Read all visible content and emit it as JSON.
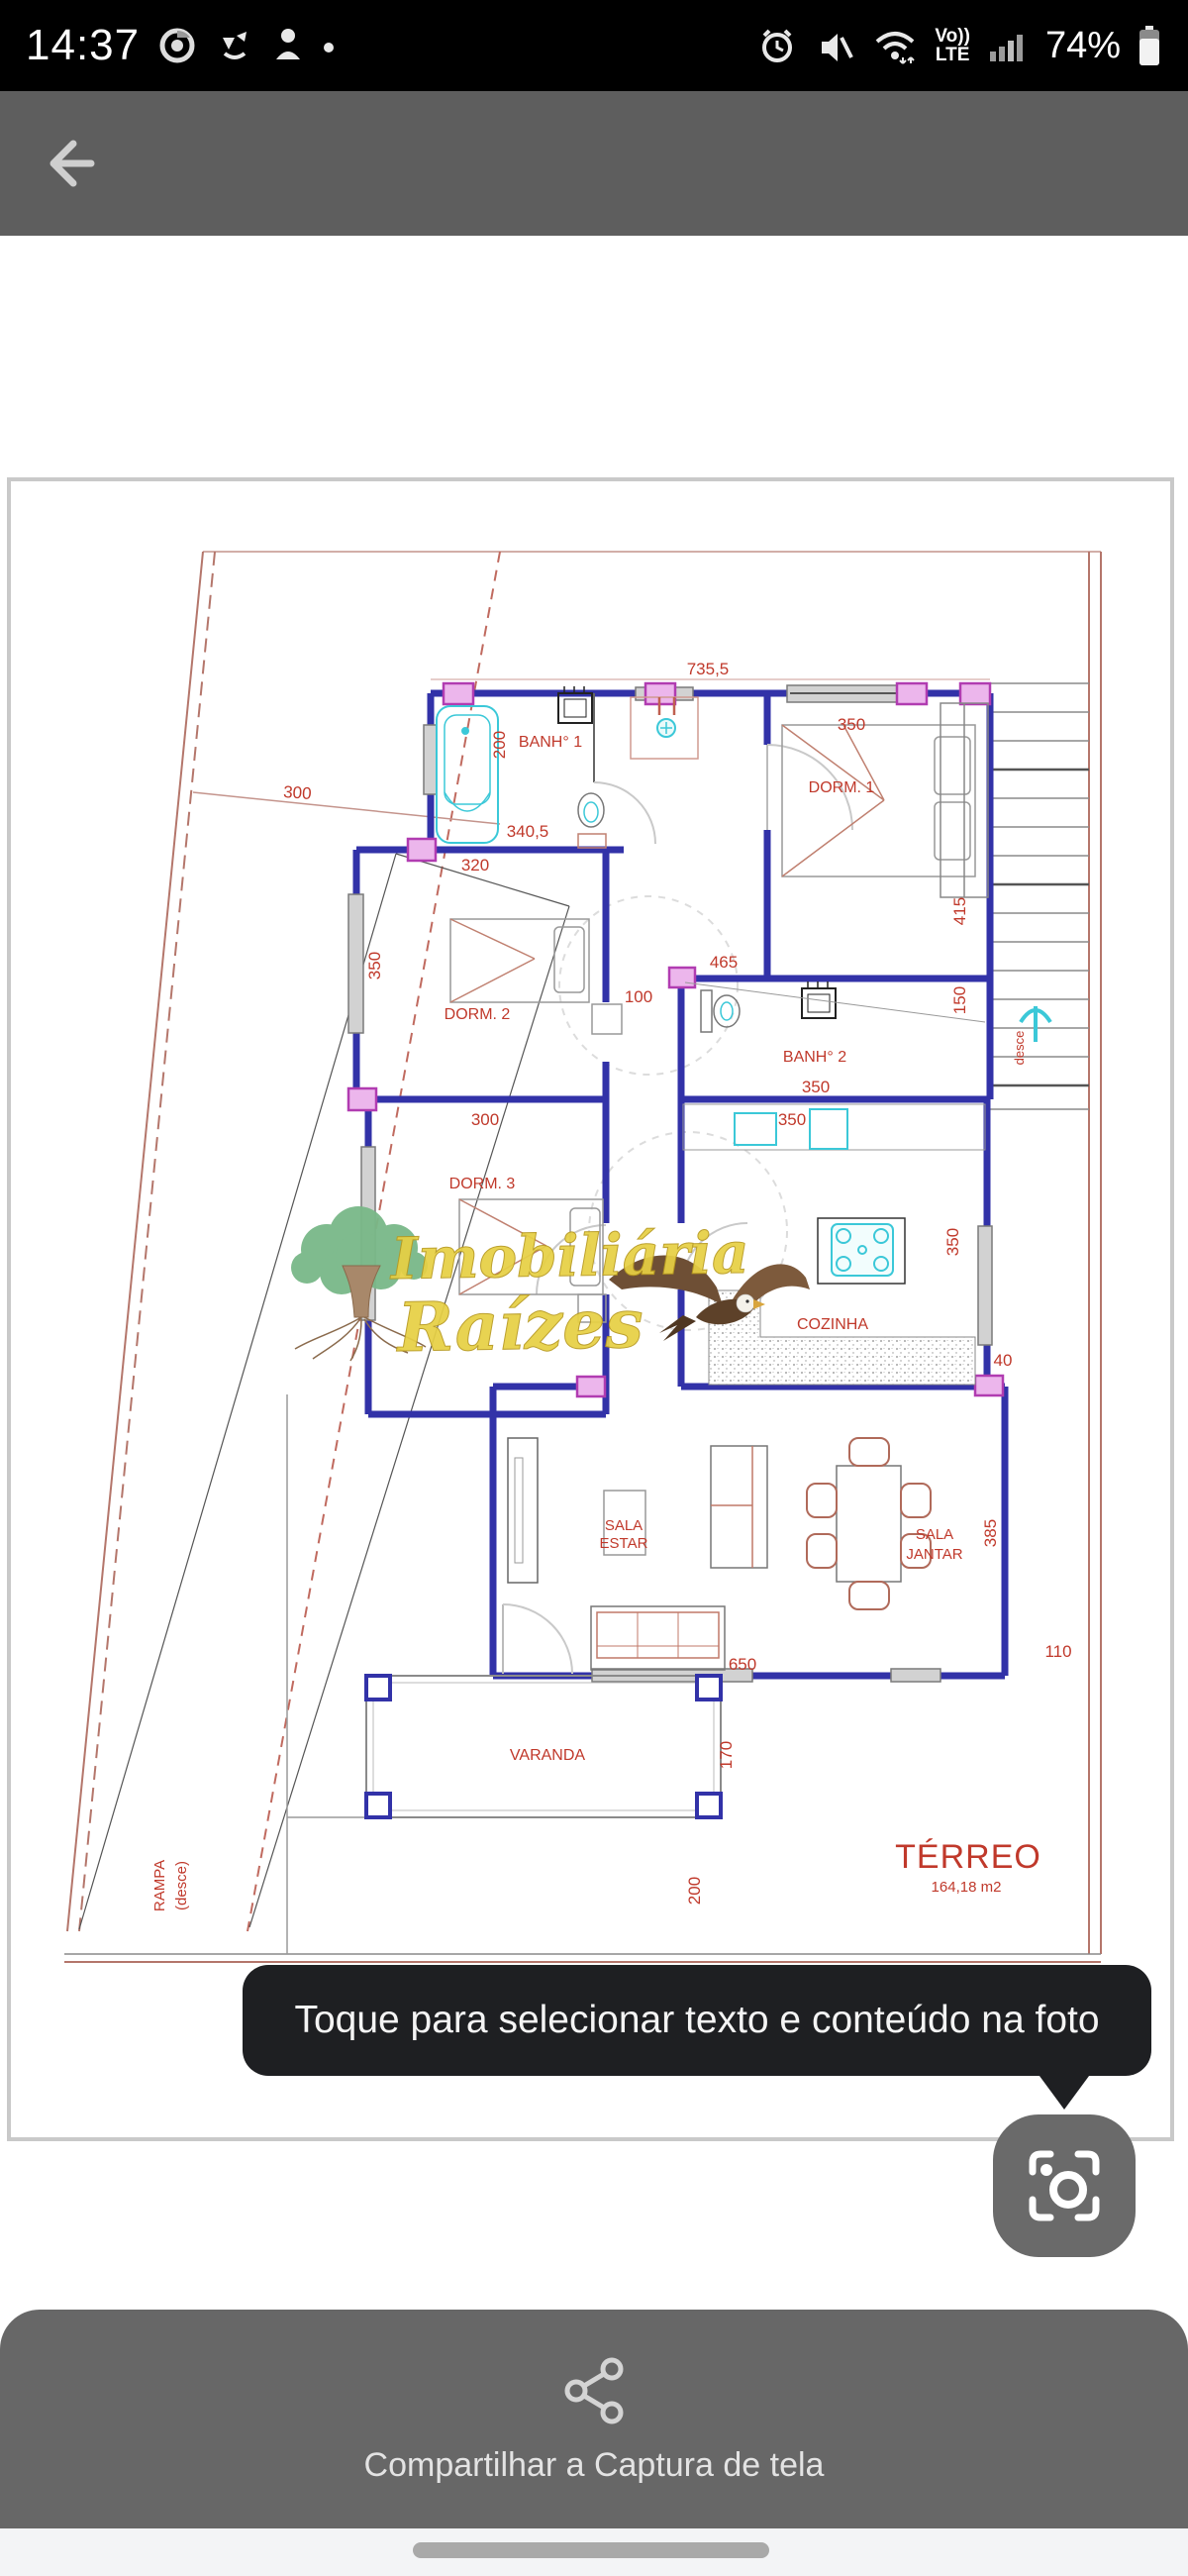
{
  "status_bar": {
    "time": "14:37",
    "battery": "74%",
    "volte_top": "Vo))",
    "volte_bottom": "LTE"
  },
  "tooltip": {
    "text": "Toque para selecionar texto e conteúdo na foto"
  },
  "share": {
    "label": "Compartilhar a Captura de tela"
  },
  "plan": {
    "watermark": {
      "line1": "Imobiliária",
      "line2": "Raízes"
    },
    "labels": [
      {
        "t": "735,5"
      },
      {
        "t": "350"
      },
      {
        "t": "200"
      },
      {
        "t": "BANH° 1"
      },
      {
        "t": "340,5"
      },
      {
        "t": "320"
      },
      {
        "t": "300"
      },
      {
        "t": "DORM. 1"
      },
      {
        "t": "415"
      },
      {
        "t": "350"
      },
      {
        "t": "DORM. 2"
      },
      {
        "t": "100"
      },
      {
        "t": "465"
      },
      {
        "t": "BANH° 2"
      },
      {
        "t": "350"
      },
      {
        "t": "150"
      },
      {
        "t": "desce"
      },
      {
        "t": "300"
      },
      {
        "t": "350"
      },
      {
        "t": "DORM. 3"
      },
      {
        "t": "COZINHA"
      },
      {
        "t": "350"
      },
      {
        "t": "40"
      },
      {
        "t": "385"
      },
      {
        "t": "SALA"
      },
      {
        "t": "ESTAR"
      },
      {
        "t": "SALA"
      },
      {
        "t": "JANTAR"
      },
      {
        "t": "650"
      },
      {
        "t": "110"
      },
      {
        "t": "VARANDA"
      },
      {
        "t": "170"
      },
      {
        "t": "200"
      },
      {
        "t": "RAMPA"
      },
      {
        "t": "(desce)"
      },
      {
        "t": "TÉRREO"
      },
      {
        "t": "164,18 m2"
      }
    ]
  },
  "colors": {
    "wall": "#3232a8",
    "dimension": "#c0392b",
    "boundary": "#b4766b",
    "fixture": "#3bc8d8",
    "column": "#cf6ad0",
    "watermark": "#e7d044",
    "tooltip_bg": "#1e1f22",
    "header_bg": "#5e5e5e",
    "share_bg": "#676767"
  }
}
